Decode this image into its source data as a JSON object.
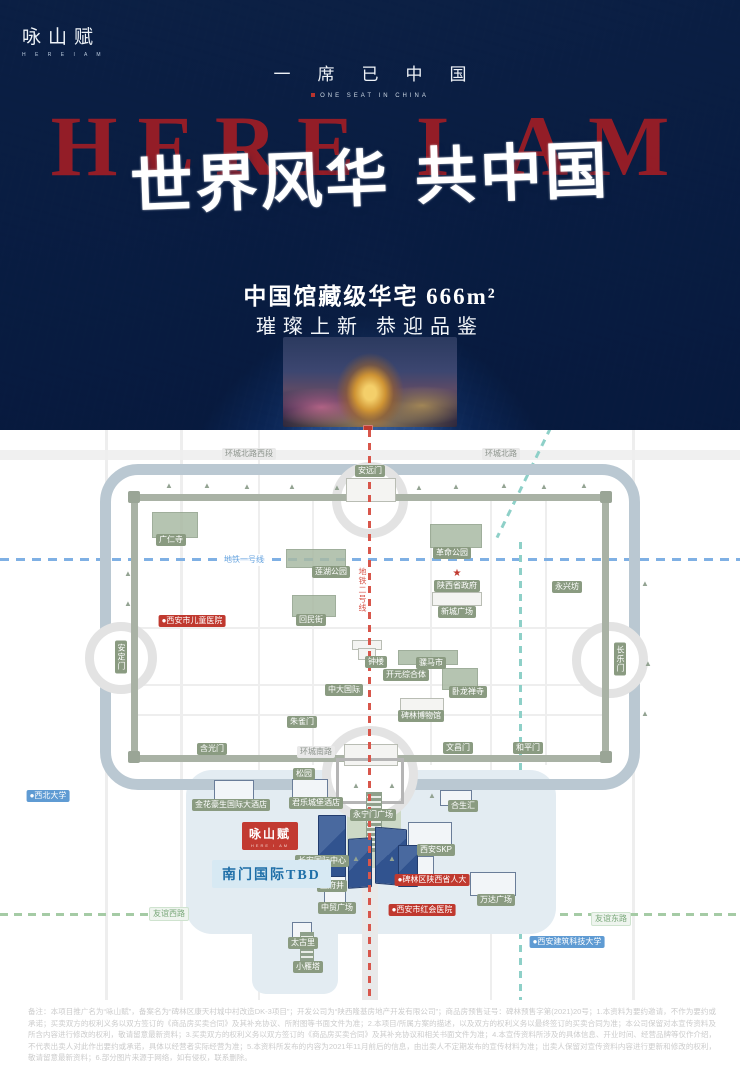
{
  "poster": {
    "logo": {
      "title": "咏山赋",
      "subtitle": "H E R E I A M"
    },
    "tagline": "一席已中国",
    "tagline_en": "ONE SEAT IN CHINA",
    "headline_en": "HERE I AM",
    "headline_cn": "世界风华 共中国",
    "spec_line1": "中国馆藏级华宅 666m²",
    "spec_line2": "璀璨上新 恭迎品鉴",
    "colors": {
      "background_blue": "#1c4e94",
      "headline_red": "#9b1d26",
      "seal_red": "#c0392f"
    }
  },
  "map": {
    "project_label": {
      "title": "咏山赋",
      "subtitle": "HERE I AM"
    },
    "tbd_label": "南门国际TBD",
    "colors": {
      "metro_line1": "#7fb0e4",
      "metro_line2": "#d8564b",
      "metro_line4": "#8ed0c8",
      "moat": "#bac8d2",
      "wall": "#a9b2a5",
      "landmark_green": "#8a9b81",
      "highlight_red": "#c0392f",
      "university_blue": "#5f9bd3"
    },
    "labels": [
      {
        "text": "环城北路西段",
        "x": 249,
        "y": 24,
        "style": "road"
      },
      {
        "text": "环城北路",
        "x": 501,
        "y": 24,
        "style": "road"
      },
      {
        "text": "安远门",
        "x": 370,
        "y": 41,
        "style": "green"
      },
      {
        "text": "广仁寺",
        "x": 171,
        "y": 110,
        "style": "green"
      },
      {
        "text": "地铁一号线",
        "x": 244,
        "y": 130,
        "style": "metro1"
      },
      {
        "text": "革命公园",
        "x": 452,
        "y": 123,
        "style": "green"
      },
      {
        "text": "莲湖公园",
        "x": 331,
        "y": 142,
        "style": "green"
      },
      {
        "text": "★",
        "x": 457,
        "y": 144,
        "style": "star"
      },
      {
        "text": "陕西省政府",
        "x": 457,
        "y": 156,
        "style": "green"
      },
      {
        "text": "永兴坊",
        "x": 567,
        "y": 157,
        "style": "green"
      },
      {
        "text": "地铁二号线",
        "x": 362,
        "y": 160,
        "style": "metro2",
        "vertical": true
      },
      {
        "text": "新城广场",
        "x": 457,
        "y": 182,
        "style": "green"
      },
      {
        "text": "●西安市儿童医院",
        "x": 192,
        "y": 191,
        "style": "red"
      },
      {
        "text": "回民街",
        "x": 311,
        "y": 190,
        "style": "green"
      },
      {
        "text": "安定门",
        "x": 121,
        "y": 227,
        "style": "green",
        "vertical": true
      },
      {
        "text": "长乐门",
        "x": 620,
        "y": 229,
        "style": "green",
        "vertical": true
      },
      {
        "text": "钟楼",
        "x": 376,
        "y": 232,
        "style": "green"
      },
      {
        "text": "骡马市",
        "x": 431,
        "y": 233,
        "style": "green"
      },
      {
        "text": "开元综合体",
        "x": 406,
        "y": 245,
        "style": "green"
      },
      {
        "text": "中大国际",
        "x": 344,
        "y": 260,
        "style": "green"
      },
      {
        "text": "卧龙禅寺",
        "x": 468,
        "y": 262,
        "style": "green"
      },
      {
        "text": "碑林博物馆",
        "x": 421,
        "y": 286,
        "style": "green"
      },
      {
        "text": "朱雀门",
        "x": 302,
        "y": 292,
        "style": "green"
      },
      {
        "text": "含光门",
        "x": 212,
        "y": 319,
        "style": "green"
      },
      {
        "text": "环城南路",
        "x": 316,
        "y": 322,
        "style": "road"
      },
      {
        "text": "文昌门",
        "x": 458,
        "y": 318,
        "style": "green"
      },
      {
        "text": "和平门",
        "x": 528,
        "y": 318,
        "style": "green"
      },
      {
        "text": "松园",
        "x": 304,
        "y": 344,
        "style": "green"
      },
      {
        "text": "●西北大学",
        "x": 48,
        "y": 366,
        "style": "blue"
      },
      {
        "text": "金花豪生国际大酒店",
        "x": 231,
        "y": 375,
        "style": "green"
      },
      {
        "text": "君乐城堡酒店",
        "x": 316,
        "y": 373,
        "style": "green"
      },
      {
        "text": "合生汇",
        "x": 463,
        "y": 376,
        "style": "green"
      },
      {
        "text": "永宁门广场",
        "x": 373,
        "y": 385,
        "style": "green"
      },
      {
        "text": "西安SKP",
        "x": 436,
        "y": 420,
        "style": "green"
      },
      {
        "text": "长安国际中心",
        "x": 322,
        "y": 431,
        "style": "green"
      },
      {
        "text": "王府井",
        "x": 332,
        "y": 456,
        "style": "green"
      },
      {
        "text": "●碑林区陕西省人大",
        "x": 432,
        "y": 450,
        "style": "red"
      },
      {
        "text": "万达广场",
        "x": 496,
        "y": 470,
        "style": "green"
      },
      {
        "text": "中贸广场",
        "x": 337,
        "y": 478,
        "style": "green"
      },
      {
        "text": "●西安市红会医院",
        "x": 422,
        "y": 480,
        "style": "red"
      },
      {
        "text": "友谊西路",
        "x": 169,
        "y": 484,
        "style": "road-green"
      },
      {
        "text": "友谊东路",
        "x": 611,
        "y": 489,
        "style": "road-green"
      },
      {
        "text": "太古里",
        "x": 303,
        "y": 513,
        "style": "green"
      },
      {
        "text": "●西安建筑科技大学",
        "x": 567,
        "y": 512,
        "style": "blue"
      },
      {
        "text": "小雁塔",
        "x": 308,
        "y": 537,
        "style": "green"
      }
    ]
  },
  "disclaimer": {
    "text": "备注：本项目推广名为“咏山赋”，备案名为“碑林区康天村城中村改造DK-3项目”；开发公司为“陕西隆基房地产开发有限公司”；商品房预售证号：碑林预售字第(2021)20号；1.本资料为要约邀请，不作为要约或承诺；买卖双方的权利义务以双方签订的《商品房买卖合同》及其补充协议、所附图等书面文件为准；2.本项目/所属方案的描述，以及双方的权利义务以最终签订的买卖合同为准；本公司保留对本宣传资料及所含内容进行修改的权利，敬请留意最新资料；3.买卖双方的权利义务以双方签订的《商品房买卖合同》及其补充协议和相关书面文件为准；4.本宣传资料所涉及的具体信息、开业时间、经营品牌等仅作介绍，不代表出卖人对此作出要约或承诺，具体以经营者实际经营为准；5.本资料所发布的内容为2021年11月前后的信息，由出卖人不定期发布的宣传材料为准；出卖人保留对宣传资料内容进行更新和修改的权利，敬请留意最新资料；6.部分图片来源于网络，如有侵权，联系删除。"
  }
}
